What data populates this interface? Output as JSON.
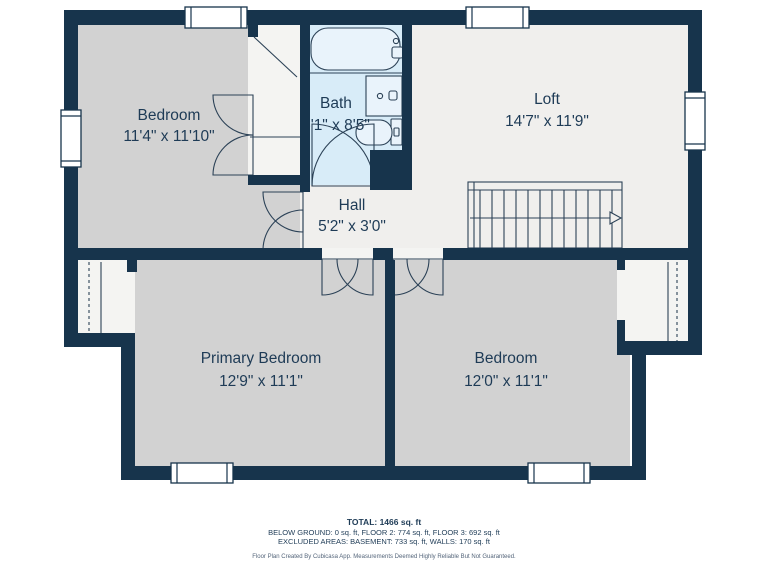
{
  "plan": {
    "rooms": [
      {
        "name": "Bedroom",
        "dims": "11'4\" x 11'10\""
      },
      {
        "name": "Bath",
        "dims": "5'1\" x 8'5\""
      },
      {
        "name": "Loft",
        "dims": "14'7\" x 11'9\""
      },
      {
        "name": "Hall",
        "dims": "5'2\" x 3'0\""
      },
      {
        "name": "Primary Bedroom",
        "dims": "12'9\" x 11'1\""
      },
      {
        "name": "Bedroom",
        "dims": "12'0\" x 11'1\""
      }
    ],
    "fixtures": [
      "bathtub",
      "vanity-sink",
      "toilet",
      "staircase"
    ],
    "colors": {
      "wall": "#17344c",
      "bedroom_floor": "#d2d2d2",
      "open_floor": "#f0efed",
      "bath_floor": "#d8ecf8",
      "closet_floor": "#f4f4f2",
      "line": "#2c4257",
      "text": "#1e3b56",
      "background": "#ffffff"
    }
  },
  "footer": {
    "total": "TOTAL: 1466 sq. ft",
    "areas_line": "BELOW GROUND: 0 sq. ft, FLOOR 2: 774 sq. ft, FLOOR 3: 692 sq. ft",
    "excluded_line": "EXCLUDED AREAS: BASEMENT: 733 sq. ft, WALLS: 170 sq. ft",
    "disclaimer": "Floor Plan Created By Cubicasa App. Measurements Deemed Highly Reliable But Not Guaranteed."
  }
}
